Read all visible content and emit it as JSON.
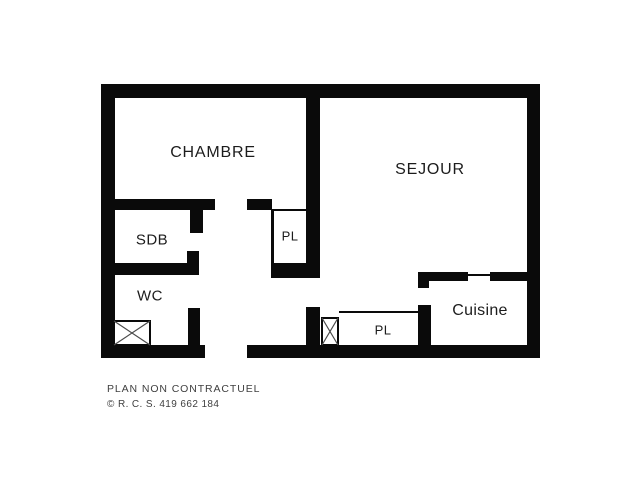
{
  "plan": {
    "rooms": {
      "chambre": {
        "label": "CHAMBRE"
      },
      "sejour": {
        "label": "SEJOUR"
      },
      "sdb": {
        "label": "SDB"
      },
      "pl_upper": {
        "label": "PL"
      },
      "wc": {
        "label": "WC"
      },
      "pl_lower": {
        "label": "PL"
      },
      "cuisine": {
        "label": "Cuisine"
      }
    },
    "symbols": {
      "wc_shaft": "crossed-box-duct",
      "hall_shaft": "crossed-box-duct"
    }
  },
  "footer": {
    "disclaimer": "PLAN NON CONTRACTUEL",
    "registration": "© R. C. S. 419 662 184"
  },
  "colors": {
    "wall": "#0a0a0a",
    "room_text": "#1c1c1c",
    "footer_text": "#3f3f3f",
    "background": "#ffffff"
  }
}
